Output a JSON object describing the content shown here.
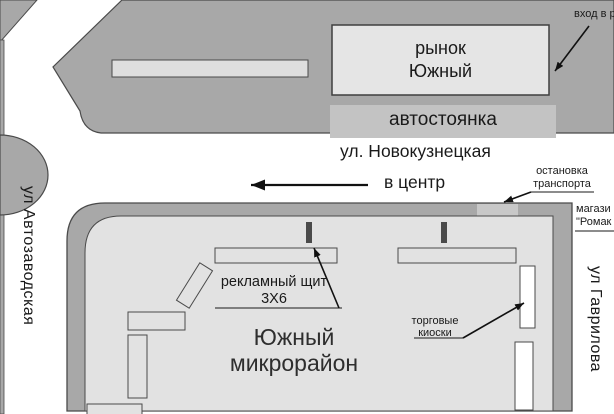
{
  "map": {
    "market": {
      "line1": "рынок",
      "line2": "Южный"
    },
    "parking": {
      "label": "автостоянка"
    },
    "streets": {
      "top": "ул. Новокузнецкая",
      "left": "ул Автозаводская",
      "right": "ул Гаврилова"
    },
    "to_center": {
      "label": "в центр"
    },
    "entrance": {
      "label": "вход в р"
    },
    "stop": {
      "line1": "остановка",
      "line2": "транспорта"
    },
    "shop": {
      "line1": "магази",
      "line2": "\"Ромак"
    },
    "billboard": {
      "line1": "рекламный щит",
      "line2": "3Х6"
    },
    "district": {
      "line1": "Южный",
      "line2": "микрорайон"
    },
    "kiosks": {
      "line1": "торговые",
      "line2": "киоски"
    }
  },
  "colors": {
    "road": "#ffffff",
    "block_gray": "#a8a8a8",
    "block_inner": "#e2e2e2",
    "market_building": "#e5e5e5",
    "parking_band": "#c3c3c3",
    "bus_stop": "#c8c8c8",
    "kiosk": "#ffffff",
    "outline": "#4a4a4a",
    "text": "#1a1a1a"
  }
}
